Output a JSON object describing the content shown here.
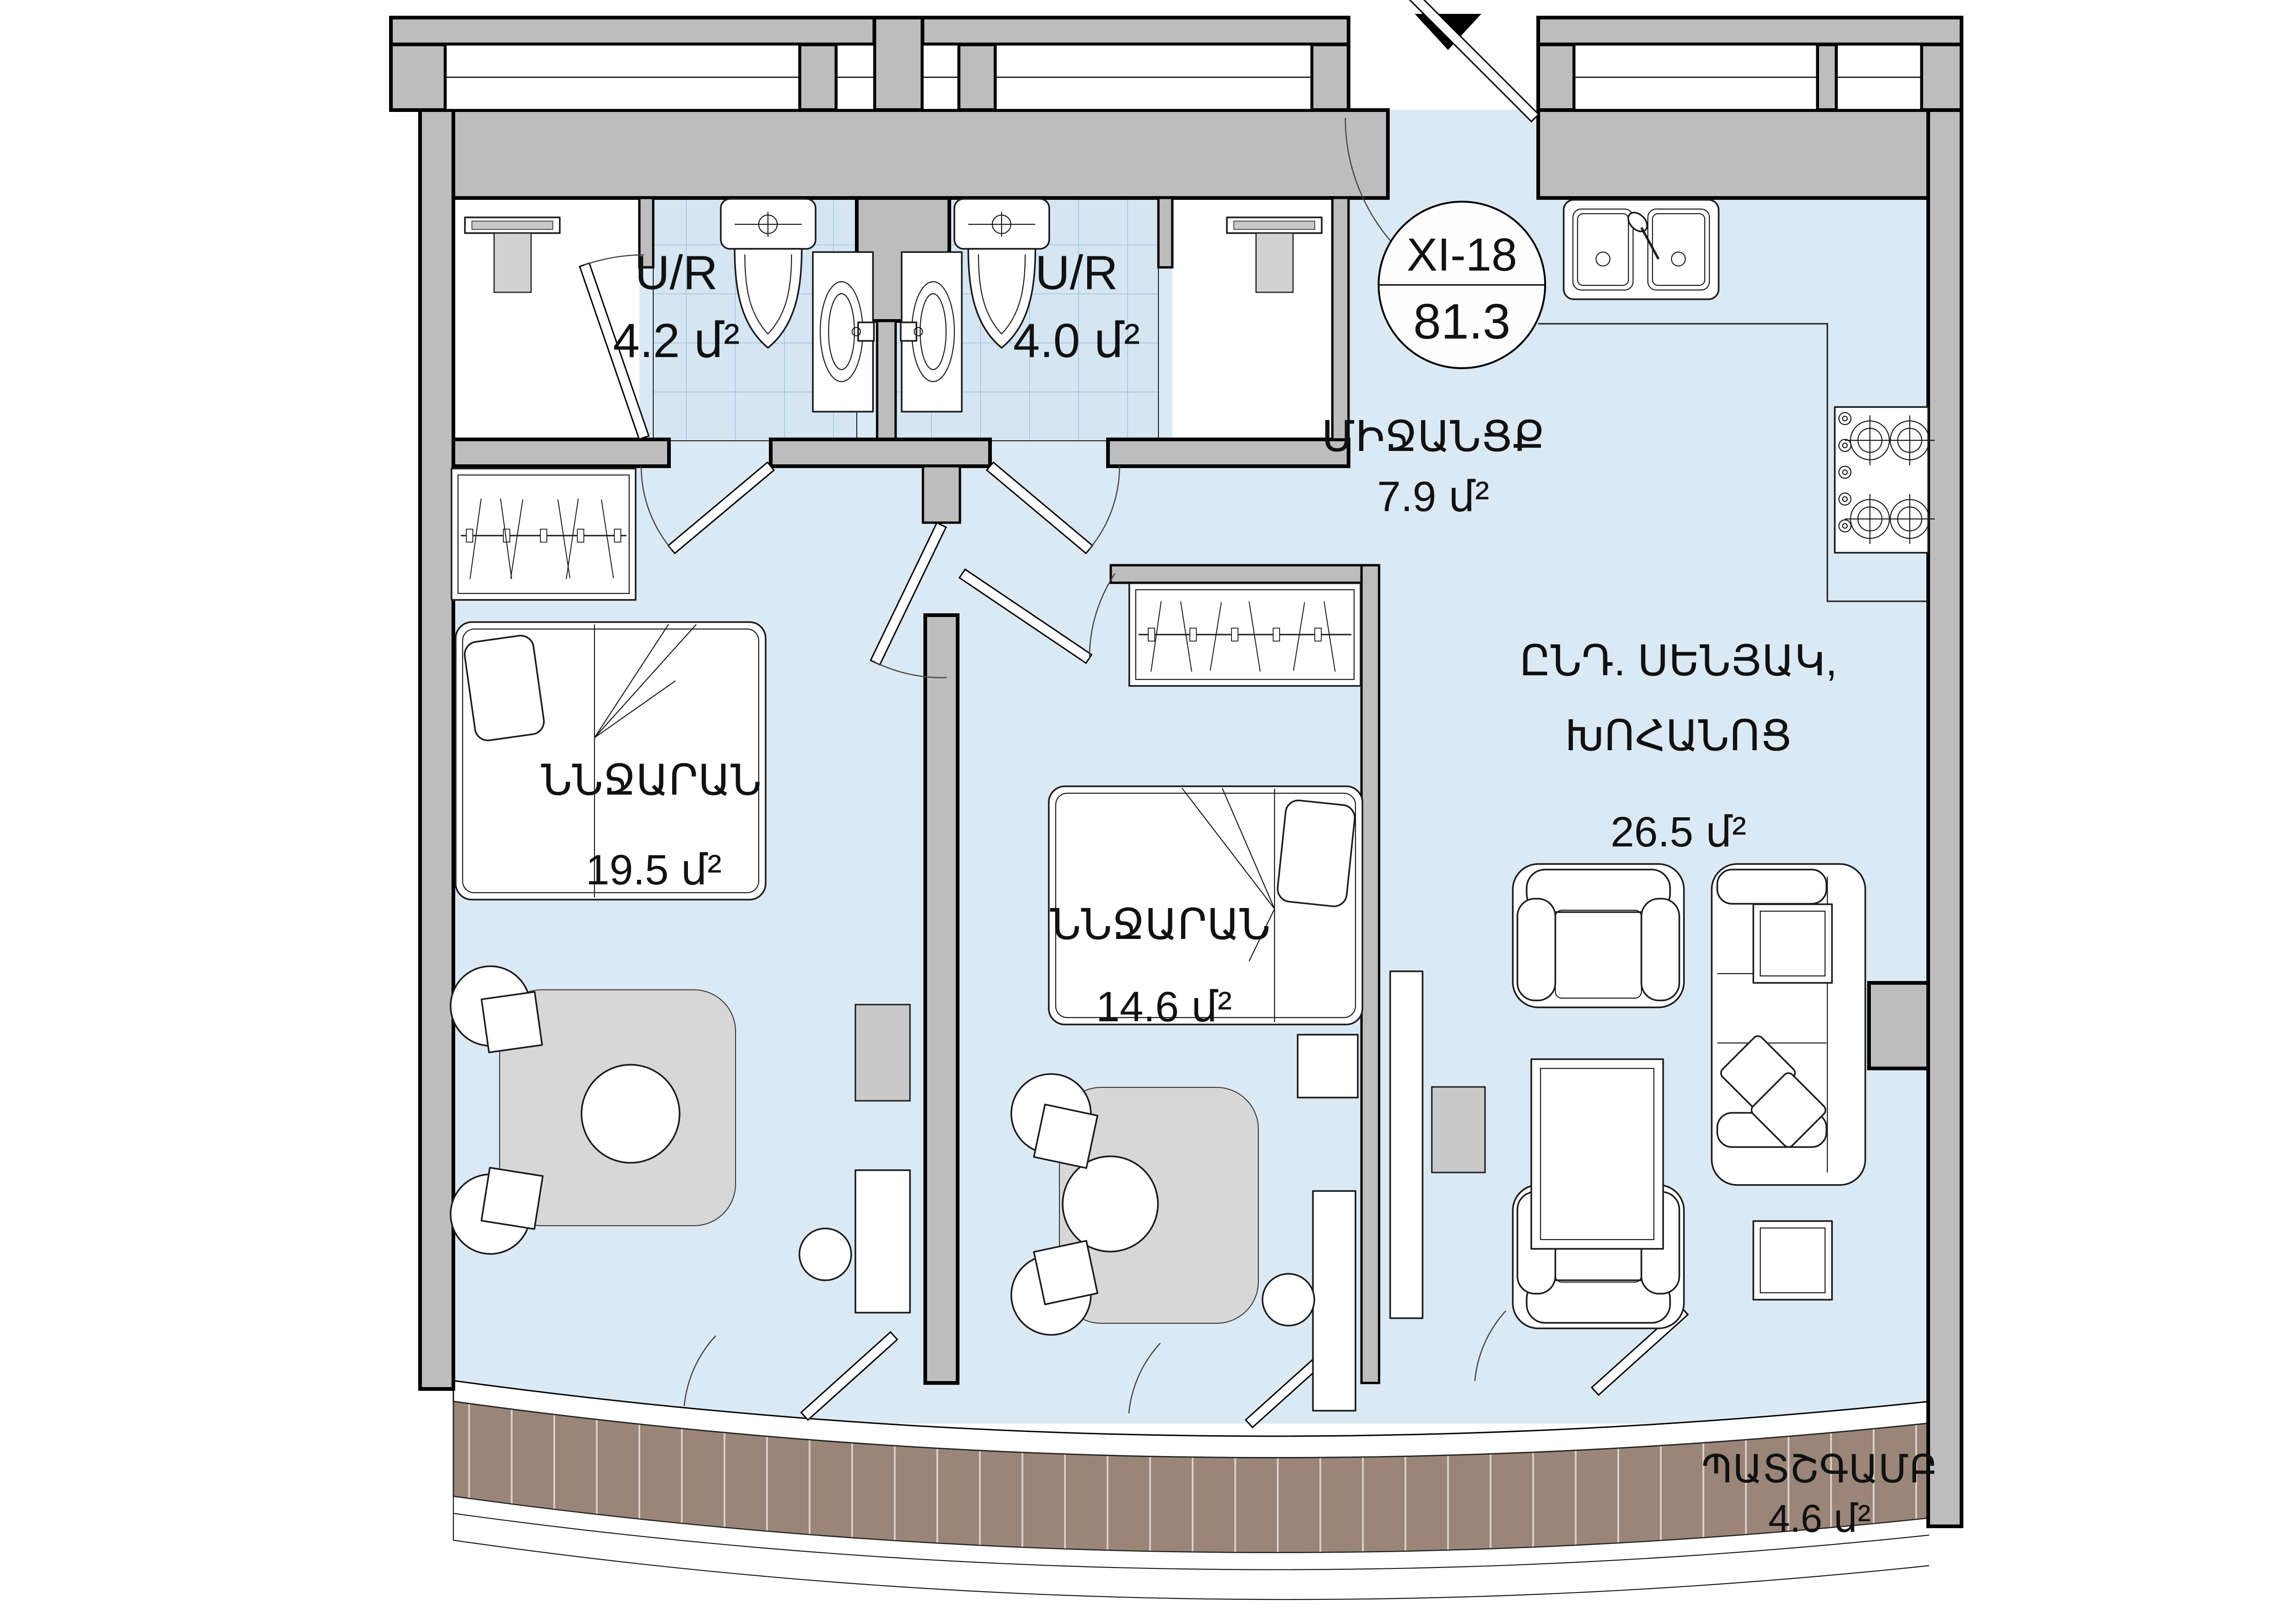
{
  "unit": {
    "code": "XI-18",
    "area_total": "81.3"
  },
  "rooms": {
    "bath1": {
      "name": "U/R",
      "area": "4.2 մ²"
    },
    "bath2": {
      "name": "U/R",
      "area": "4.0 մ²"
    },
    "hallway": {
      "name": "ՄԻՋԱՆՑՔ",
      "area": "7.9 մ²"
    },
    "living": {
      "name_line1": "ԸՆԴ. ՍԵՆՅԱԿ,",
      "name_line2": "ԽՈՀԱՆՈՑ",
      "area": "26.5 մ²"
    },
    "bedroom1": {
      "name": "ՆՆՋԱՐԱՆ",
      "area": "19.5 մ²"
    },
    "bedroom2": {
      "name": "ՆՆՋԱՐԱՆ",
      "area": "14.6 մ²"
    },
    "balcony": {
      "name": "ՊԱՏՇԳԱՄԲ",
      "area": "4.6 մ²"
    }
  },
  "markers": {
    "entry": "▼"
  },
  "colors": {
    "floor": "#dbe9f4",
    "tile": "#d5e6f2",
    "tile_line": "#8ab1cf",
    "wall": "#bdbdbd",
    "deck": "#9a8578",
    "deck_line": "#d8cfc8",
    "rug": "#d7d7d7",
    "outline": "#000000"
  }
}
